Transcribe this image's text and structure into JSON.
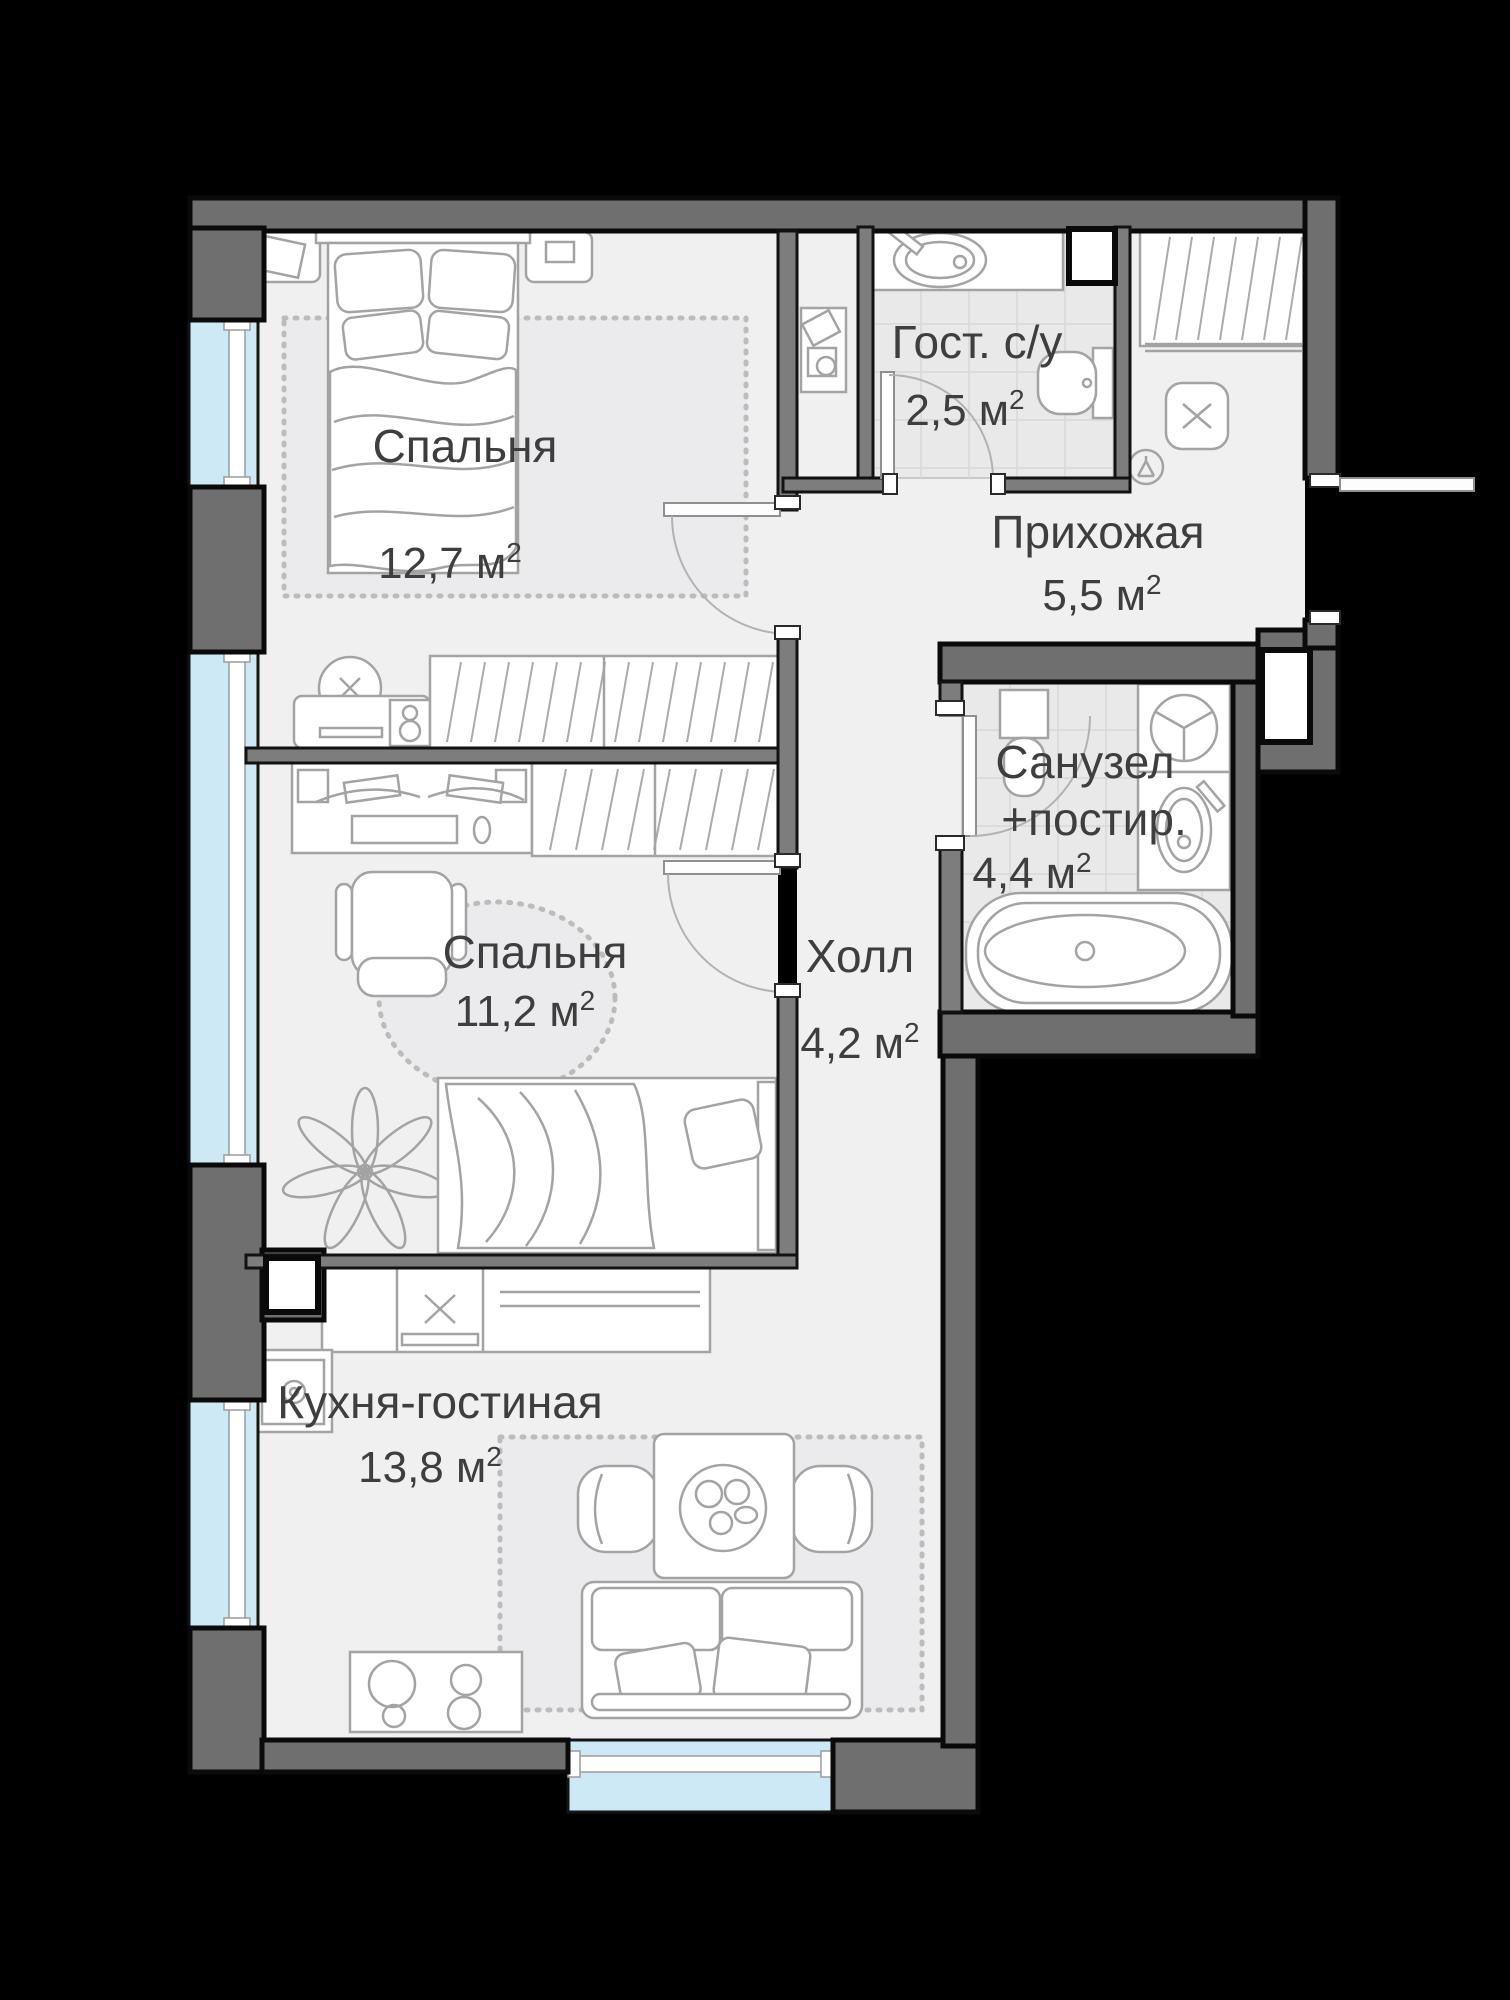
{
  "plan": {
    "type": "apartment-floor-plan",
    "language": "ru",
    "sup": "2",
    "rooms": {
      "bedroom_1": {
        "name": "Спальня",
        "area": "12,7 м"
      },
      "guest_wc": {
        "name": "Гост. с/у",
        "area": "2,5 м"
      },
      "hallway": {
        "name": "Прихожая",
        "area": "5,5 м"
      },
      "bathroom": {
        "name_line1": "Санузел",
        "name_line2": "+постир.",
        "area": "4,4 м"
      },
      "hall": {
        "name": "Холл",
        "area": "4,2 м"
      },
      "bedroom_2": {
        "name": "Спальня",
        "area": "11,2 м"
      },
      "kitchen_living": {
        "name": "Кухня-гостиная",
        "area": "13,8 м"
      }
    },
    "colors": {
      "background": "#000000",
      "exterior_wall": "#6f6f6f",
      "interior_wall": "#7d7d7d",
      "floor": "#f0f0f1",
      "tile_floor": "#e9e9ea",
      "window_glazing": "#cde9f6",
      "furniture_line": "#a3a3a3",
      "label_text": "#3e3e3e"
    }
  }
}
